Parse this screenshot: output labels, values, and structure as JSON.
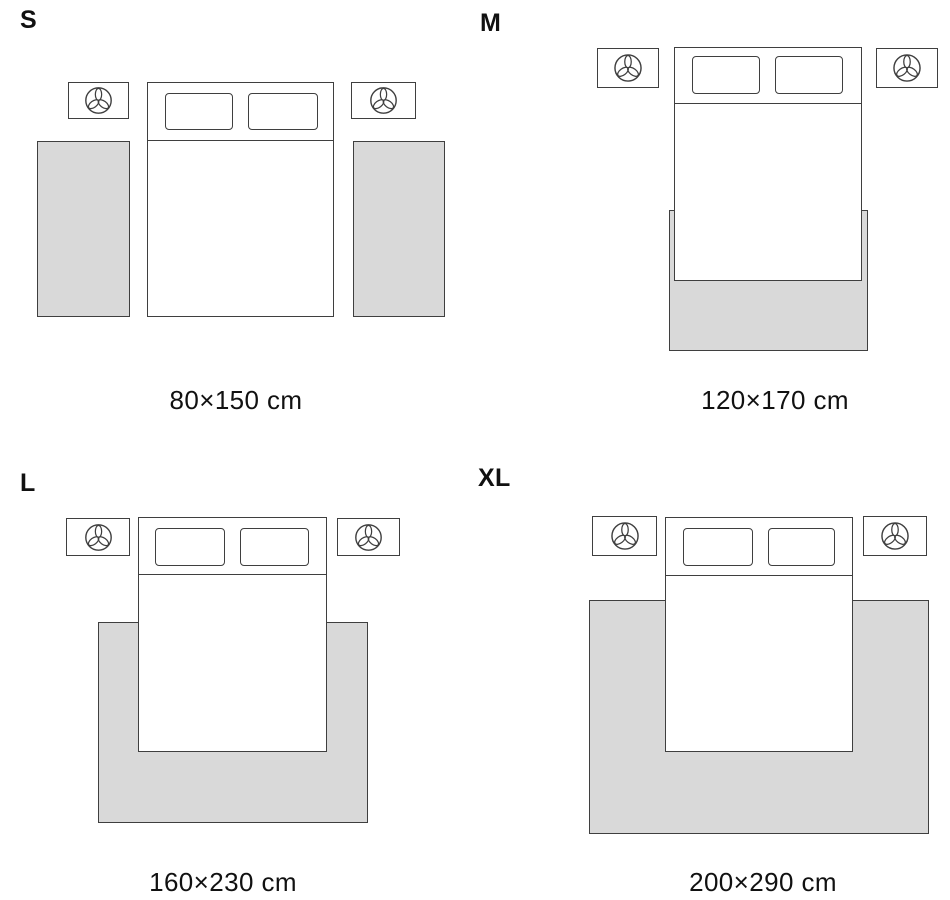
{
  "colors": {
    "page_bg": "#ffffff",
    "rug_fill": "#d9d9d9",
    "line": "#3f3f3f",
    "text": "#111111"
  },
  "sizes": [
    {
      "id": "S",
      "label": "S",
      "caption": "80×150 cm"
    },
    {
      "id": "M",
      "label": "M",
      "caption": "120×170 cm"
    },
    {
      "id": "L",
      "label": "L",
      "caption": "160×230 cm"
    },
    {
      "id": "XL",
      "label": "XL",
      "caption": "200×290 cm"
    }
  ],
  "icons": {
    "nightstand": "plant-icon"
  }
}
